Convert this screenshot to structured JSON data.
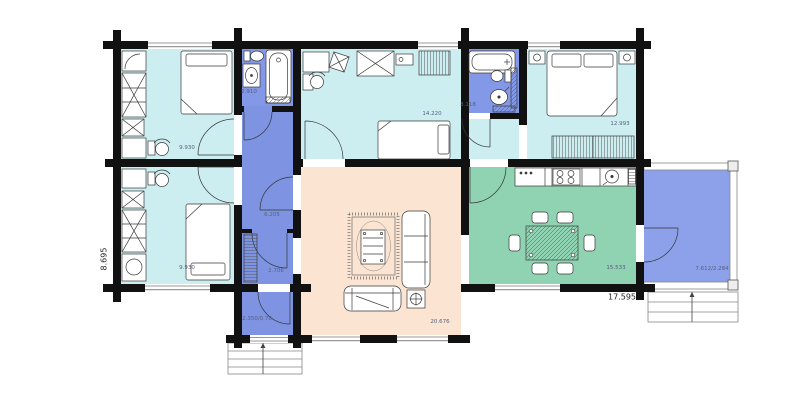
{
  "title": "log-house-floor-plan",
  "colors": {
    "bedroom_fill": "#cdeef1",
    "bathroom_fill": "#8398e6",
    "hall_fill": "#7e94e2",
    "terrace_fill": "#8da1ea",
    "living_fill": "#fbe5d2",
    "dining_fill": "#90d3b2",
    "wall": "#111111"
  },
  "rooms": {
    "bedroom_top_left": {
      "name": "bedroom",
      "area": "9.930"
    },
    "bathroom_1": {
      "name": "bathroom",
      "area": "2.910"
    },
    "bedroom_top_center": {
      "name": "bedroom",
      "area": "14.220"
    },
    "bathroom_2": {
      "name": "bathroom",
      "area": "3.118"
    },
    "bedroom_top_right": {
      "name": "bedroom",
      "area": "12.993"
    },
    "bedroom_bottom_left": {
      "name": "bedroom",
      "area": "9.930"
    },
    "hall_upper": {
      "name": "hall",
      "area": "6.205"
    },
    "hall_lower": {
      "name": "hall",
      "area": "2.706"
    },
    "entry": {
      "name": "entry",
      "area": "2.350/0.70"
    },
    "living_room": {
      "name": "living-room",
      "area": "20.676"
    },
    "dining_kitchen": {
      "name": "kitchen-dining",
      "area": "15.533"
    },
    "terrace": {
      "name": "terrace",
      "area": "7.612/2.284"
    }
  },
  "dimensions": {
    "overall_width": "17.595",
    "overall_height": "8.695"
  }
}
